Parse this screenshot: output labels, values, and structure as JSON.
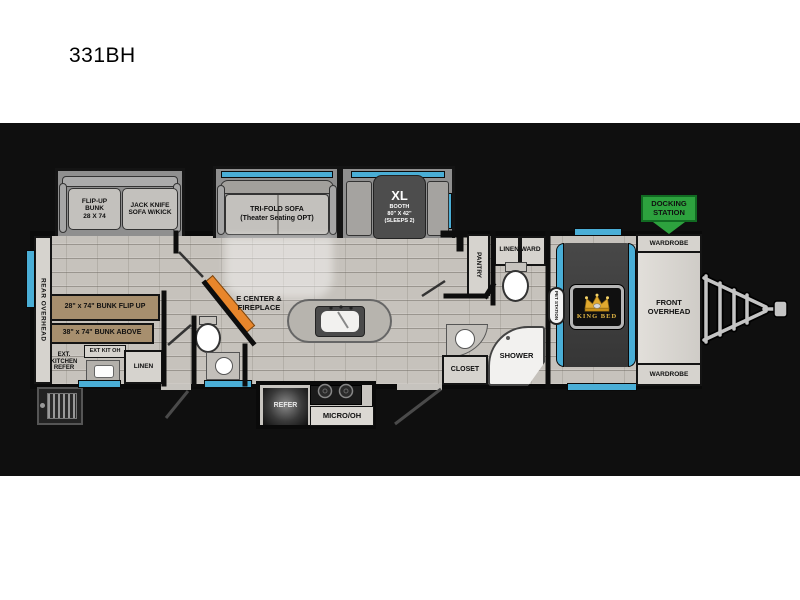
{
  "title": "331BH",
  "plan": {
    "rear_overhead": "REAR OVERHEAD",
    "slideouts": {
      "bunk_sofa": {
        "bunk_label": "FLIP-UP\nBUNK\n28 X 74",
        "sofa_label": "JACK KNIFE\nSOFA W/KICK"
      },
      "tri_fold": {
        "label": "TRI-FOLD SOFA\n(Theater Seating OPT)"
      },
      "booth": {
        "title": "XL",
        "details": "BOOTH\n80\" X 42\"\n(SLEEPS 2)"
      }
    },
    "bunk_room": {
      "bunk_flip_up": "28\" x 74\" BUNK FLIP UP",
      "bunk_above": "38\" x 74\" BUNK ABOVE",
      "ext_kitchen": "EXT.\nKITCHEN\nREFER",
      "ext_kit_oh": "EXT KIT OH",
      "linen": "LINEN"
    },
    "living": {
      "e_center": "E CENTER &\nFIREPLACE"
    },
    "kitchen": {
      "refer": "REFER",
      "micro": "MICRO/OH"
    },
    "bath": {
      "pantry": "PANTRY",
      "linen_ward": "LINEN/WARD",
      "closet": "CLOSET",
      "shower": "SHOWER"
    },
    "bedroom": {
      "pet_station": "PET STATION",
      "king_bed": "KING BED",
      "wardrobe_top": "WARDROBE",
      "wardrobe_bottom": "WARDROBE",
      "front_overhead": "FRONT\nOVERHEAD"
    },
    "docking_station": "DOCKING\nSTATION",
    "colors": {
      "accent_blue": "#4aaed6",
      "docking_green": "#2da23e",
      "fireplace_orange": "#e8862b",
      "bunk_tan": "#a78f6e",
      "crown_gold": "#e0a92f",
      "background": "#0f0f0f"
    }
  }
}
